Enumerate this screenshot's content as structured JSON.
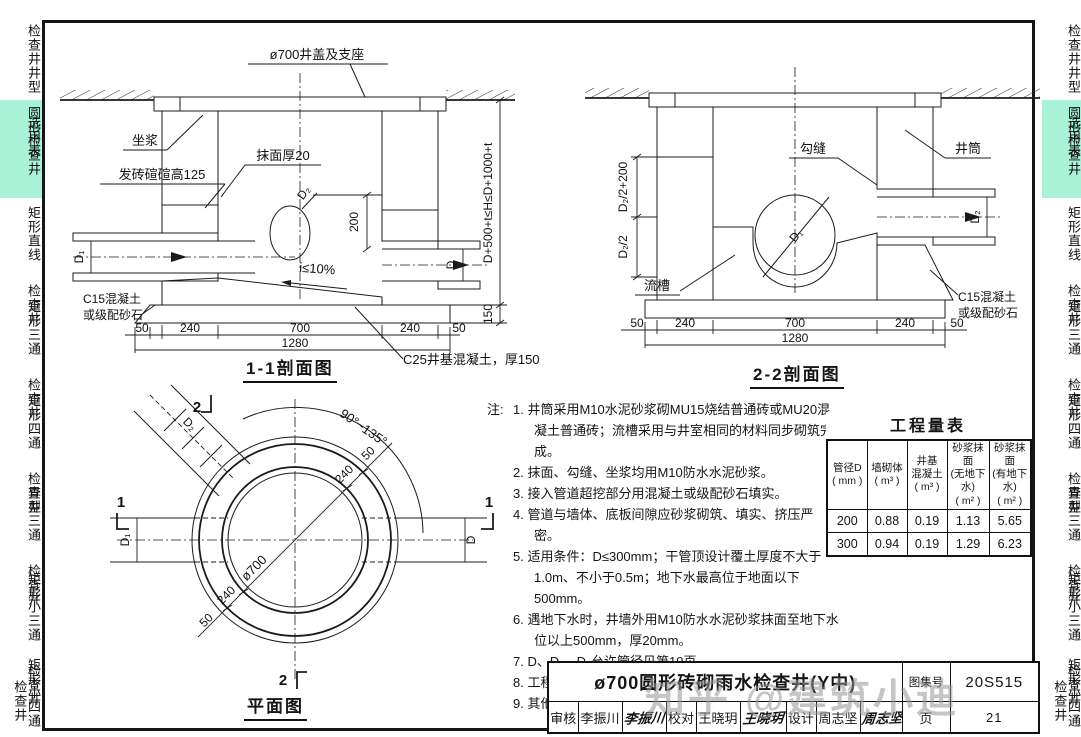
{
  "page": {
    "watermark": "知乎 @建筑小迪"
  },
  "sidebar": {
    "highlight_color": "#a9f2d8",
    "items": [
      {
        "primary": "检查井井型",
        "secondary": "选用表",
        "highlighted": false
      },
      {
        "primary": "圆形检查井",
        "secondary": "",
        "highlighted": true
      },
      {
        "primary": "矩形直线",
        "secondary": "检查井",
        "highlighted": false
      },
      {
        "primary": "矩形三通",
        "secondary": "检查井",
        "highlighted": false
      },
      {
        "primary": "矩形四通",
        "secondary": "检查井",
        "highlighted": false
      },
      {
        "primary": "异型三通",
        "secondary": "检查井",
        "highlighted": false
      },
      {
        "primary": "矩形小三通",
        "secondary": "检查井",
        "highlighted": false
      },
      {
        "primary": "矩形小四通",
        "secondary": "检查井",
        "highlighted": false
      }
    ]
  },
  "section1": {
    "title": "1-1剖面图",
    "label_cover": "ø700井盖及支座",
    "label_zuojiang": "坐浆",
    "label_momian": "抹面厚20",
    "label_fazhuan": "发砖碹碹高125",
    "label_c15_1": "C15混凝土",
    "label_c15_2": "或级配砂石",
    "label_c25": "C25井基混凝土，厚150",
    "label_slope": "i≤10%",
    "label_h": "D+500+t≤H≤D+1000+t",
    "dim_150": "150",
    "dim_200": "200",
    "label_d1": "D₁",
    "label_d2": "D₂",
    "label_d": "D",
    "dims": [
      "50",
      "240",
      "700",
      "240",
      "50"
    ],
    "dim_total": "1280"
  },
  "section2": {
    "title": "2-2剖面图",
    "label_goufeng": "勾缝",
    "label_jingtong": "井筒",
    "label_liucao": "流槽",
    "label_c15_1": "C15混凝土",
    "label_c15_2": "或级配砂石",
    "label_d1": "D₁",
    "label_d2": "D₂",
    "dim_d2a": "D₂/2+200",
    "dim_d2b": "D₂/2",
    "dims": [
      "50",
      "240",
      "700",
      "240",
      "50"
    ],
    "dim_total": "1280"
  },
  "plan": {
    "title": "平面图",
    "label_dia": "ø700",
    "label_angle": "90°~135°",
    "label_d1": "D₁",
    "label_d2": "D₂",
    "label_d": "D",
    "cut1": "1",
    "cut2": "2",
    "dim_50a": "50",
    "dim_240a": "240",
    "dim_240b": "240",
    "dim_50b": "50"
  },
  "notes": {
    "prefix": "注:",
    "items": [
      "1. 井筒采用M10水泥砂浆砌MU15烧结普通砖或MU20混凝土普通砖；流槽采用与井室相同的材料同步砌筑完成。",
      "2. 抹面、勾缝、坐浆均用M10防水水泥砂浆。",
      "3. 接入管道超挖部分用混凝土或级配砂石填实。",
      "4. 管道与墙体、底板间隙应砂浆砌筑、填实、挤压严密。",
      "5. 适用条件：D≤300mm；干管顶设计覆土厚度不大于1.0m、不小于0.5m；地下水最高位于地面以下500mm。",
      "6. 遇地下水时，井墙外用M10防水水泥砂浆抹面至地下水位以上500mm，厚20mm。",
      "7. D、D₁、D₂允许管径见第19页。",
      "8. 工程量按 H 最大值计算。",
      "9. 其他详见总说明。"
    ]
  },
  "quantity_table": {
    "title": "工程量表",
    "headers": [
      "管径D\n( mm )",
      "墙砌体\n( m³ )",
      "井基\n混凝土\n( m³ )",
      "砂浆抹面\n(无地下水)\n( m² )",
      "砂浆抹面\n(有地下水)\n( m² )"
    ],
    "rows": [
      [
        "200",
        "0.88",
        "0.19",
        "1.13",
        "5.65"
      ],
      [
        "300",
        "0.94",
        "0.19",
        "1.29",
        "6.23"
      ]
    ]
  },
  "titleblock": {
    "title": "ø700圆形砖砌雨水检查井(Y中)",
    "atlas_label": "图集号",
    "atlas_no": "20S515",
    "page_label": "页",
    "page_no": "21",
    "roles": [
      {
        "label": "审核",
        "name": "李振川",
        "sig": "李振川"
      },
      {
        "label": "校对",
        "name": "王晓玥",
        "sig": "王晓玥"
      },
      {
        "label": "设计",
        "name": "周志坚",
        "sig": "周志坚"
      }
    ]
  }
}
